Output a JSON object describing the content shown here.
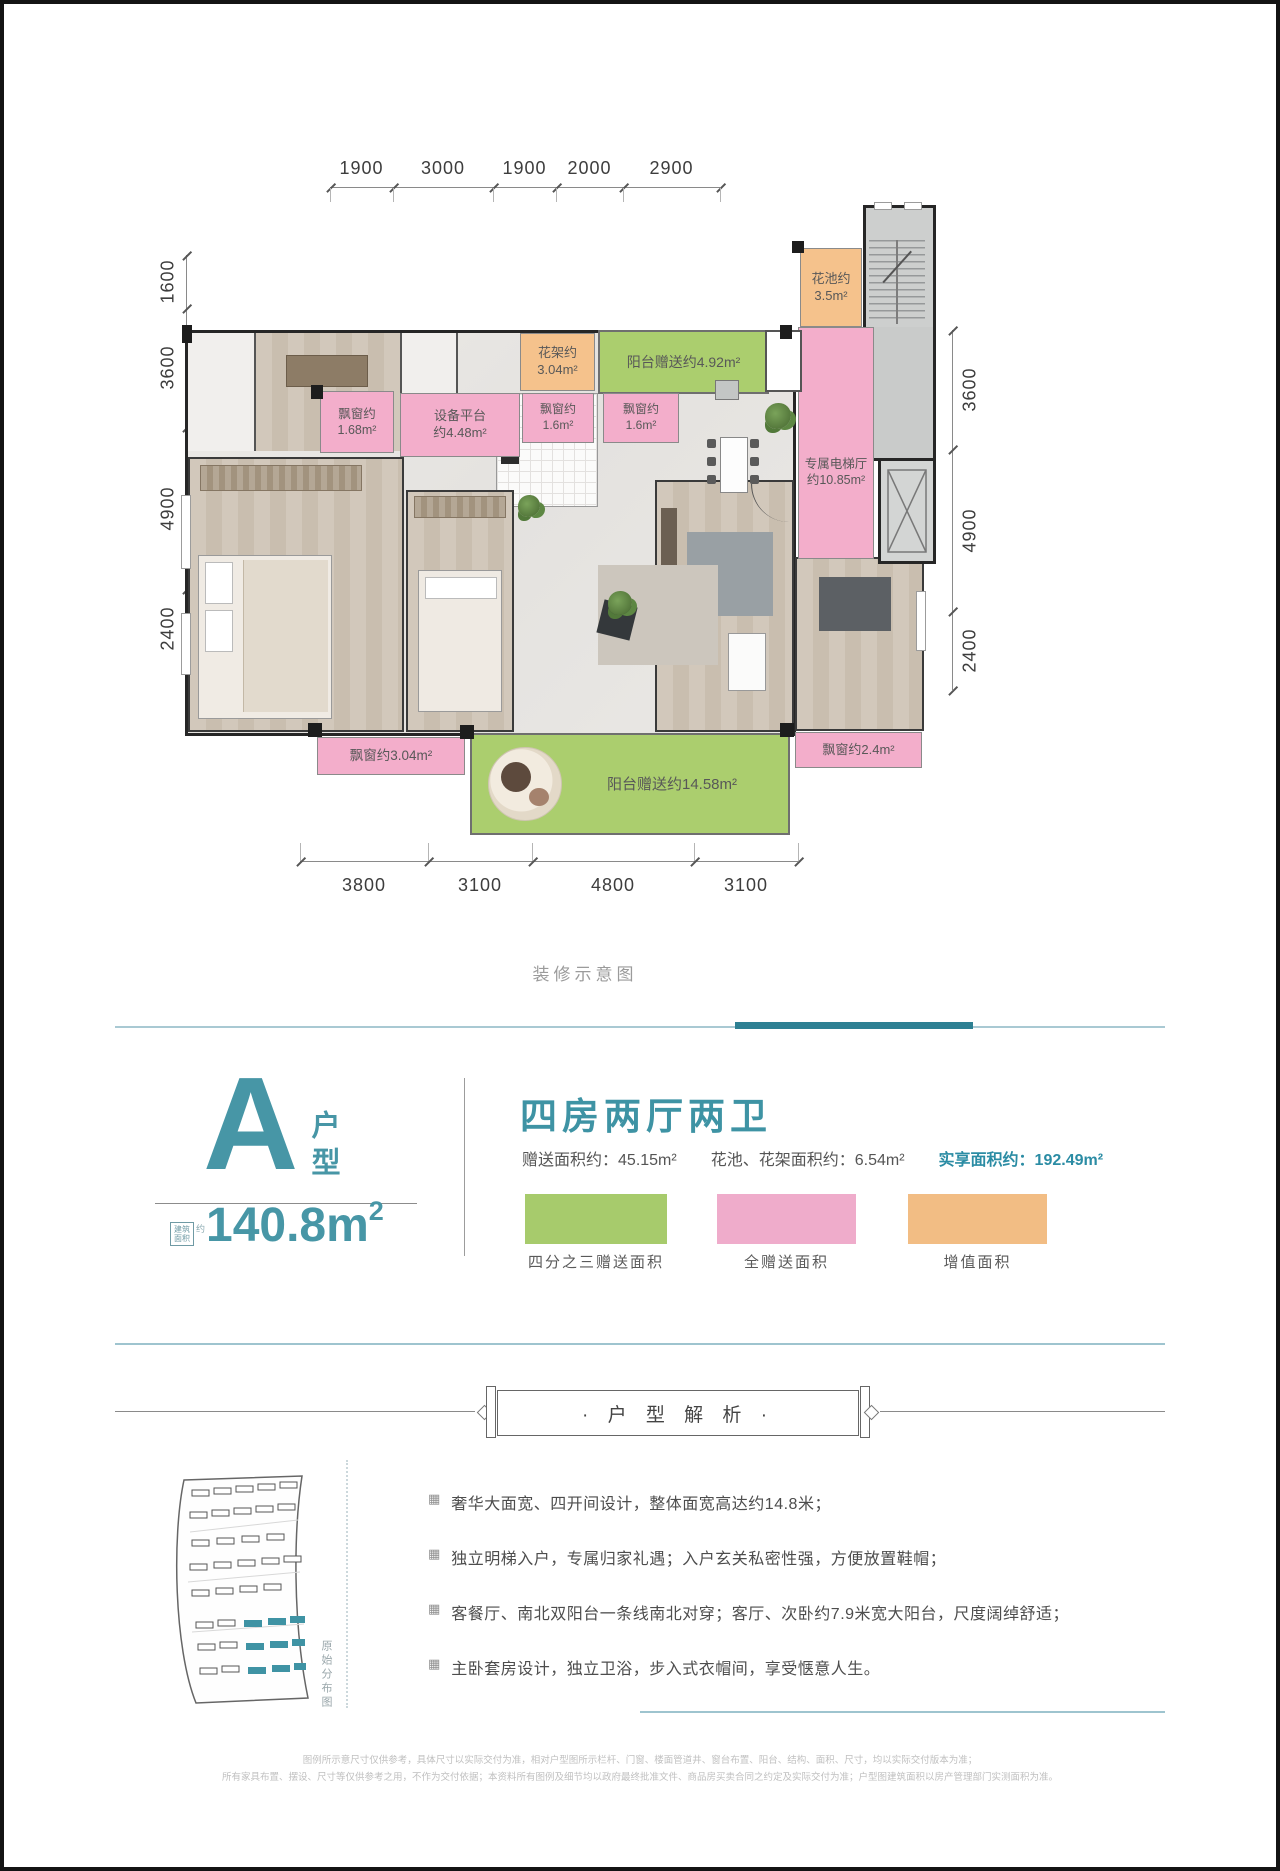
{
  "colors": {
    "accent_teal": "#4796a6",
    "legend_green": "#a7cb6c",
    "legend_pink": "#efaccb",
    "legend_orange": "#f2bd84",
    "plan_green": "#abce6e",
    "plan_pink": "#f3aecb",
    "plan_orange": "#f5c28c"
  },
  "dims": {
    "top": [
      "1900",
      "3000",
      "1900",
      "2000",
      "2900"
    ],
    "left": [
      "1600",
      "3600",
      "4900",
      "2400"
    ],
    "right": [
      "3600",
      "4900",
      "2400"
    ],
    "bottom": [
      "3800",
      "3100",
      "4800",
      "3100"
    ]
  },
  "plan": {
    "caption": "装修示意图",
    "flower_pool_l1": "花池约",
    "flower_pool_l2": "3.5m²",
    "flower_stand_l1": "花架约",
    "flower_stand_l2": "3.04m²",
    "balcony_north": "阳台赠送约4.92m²",
    "bay1_l1": "飘窗约",
    "bay1_l2": "1.68m²",
    "equip_l1": "设备平台",
    "equip_l2": "约4.48m²",
    "bay2_l1": "飘窗约",
    "bay2_l2": "1.6m²",
    "bay3_l1": "飘窗约",
    "bay3_l2": "1.6m²",
    "lift_hall_l1": "专属电梯厅",
    "lift_hall_l2": "约10.85m²",
    "bay4": "飘窗约3.04m²",
    "balcony_south": "阳台赠送约14.58m²",
    "bay5": "飘窗约2.4m²"
  },
  "unit": {
    "letter": "A",
    "type_label": "户型",
    "badge_l1": "建筑",
    "badge_l2": "面积",
    "badge_approx": "约",
    "area_value": "140.8m",
    "area_sup": "2",
    "rooms_title": "四房两厅两卫",
    "stat1_label": "赠送面积约：",
    "stat1_value": "45.15m²",
    "stat2_label": "花池、花架面积约：",
    "stat2_value": "6.54m²",
    "stat3_label": "实享面积约：",
    "stat3_value": "192.49m²",
    "legend_green": "四分之三赠送面积",
    "legend_pink": "全赠送面积",
    "legend_orange": "增值面积"
  },
  "analysis": {
    "title": "· 户 型 解 析 ·",
    "site_caption": "原始分布图",
    "bullets": [
      "奢华大面宽、四开间设计，整体面宽高达约14.8米；",
      "独立明梯入户，专属归家礼遇；入户玄关私密性强，方便放置鞋帽；",
      "客餐厅、南北双阳台一条线南北对穿；客厅、次卧约7.9米宽大阳台，尺度阔绰舒适；",
      "主卧套房设计，独立卫浴，步入式衣帽间，享受惬意人生。"
    ],
    "bullet_icon": "▦"
  },
  "disclaimer": {
    "line1": "图例所示意尺寸仅供参考，具体尺寸以实际交付为准，相对户型图所示栏杆、门窗、楼面管道井、窗台布置、阳台、结构、面积、尺寸，均以实际交付版本为准；",
    "line2": "所有家具布置、摆设、尺寸等仅供参考之用，不作为交付依据；本资料所有图例及细节均以政府最终批准文件、商品房买卖合同之约定及实际交付为准；户型图建筑面积以房产管理部门实测面积为准。"
  }
}
